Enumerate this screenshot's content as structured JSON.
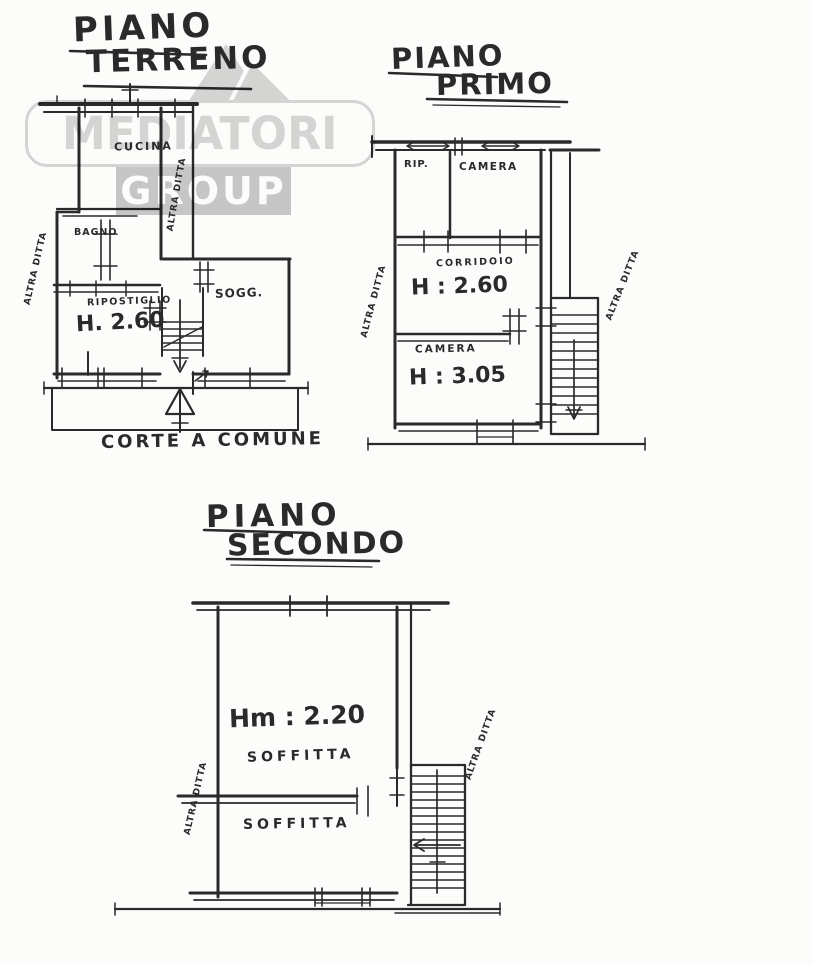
{
  "colors": {
    "ink": "#2a2a2a",
    "paper": "#fcfcfb",
    "watermark_gray": "#d7d7d7",
    "watermark_block": "#c9c9c9",
    "watermark_text": "#ffffff"
  },
  "watermark": {
    "brand_top": "MEDIATORI",
    "brand_bottom": "GROUP",
    "logo": "mountain-peaks-icon"
  },
  "plans": {
    "ground": {
      "title1": "PIANO",
      "title2": "TERRENO",
      "labels": {
        "cucina": "CUCINA",
        "bagno": "BAGNO",
        "ripostiglio": "RIPOSTIGLIO",
        "height": "H. 2.60",
        "sogg": "SOGG.",
        "corte": "CORTE A COMUNE",
        "side_left": "ALTRA DITTA",
        "side_inner": "ALTRA DITTA"
      }
    },
    "first": {
      "title1": "PIANO",
      "title2": "PRIMO",
      "labels": {
        "rip": "RIP.",
        "camera_top": "CAMERA",
        "corridoio": "CORRIDOIO",
        "height_top": "H : 2.60",
        "camera_bottom": "CAMERA",
        "height_bottom": "H : 3.05",
        "side_left": "ALTRA DITTA",
        "side_right": "ALTRA DITTA"
      }
    },
    "second": {
      "title1": "PIANO",
      "title2": "SECONDO",
      "labels": {
        "height": "Hm : 2.20",
        "soffitta_top": "SOFFITTA",
        "soffitta_bottom": "SOFFITTA",
        "side_left": "ALTRA DITTA",
        "side_right": "ALTRA DITTA"
      }
    }
  }
}
